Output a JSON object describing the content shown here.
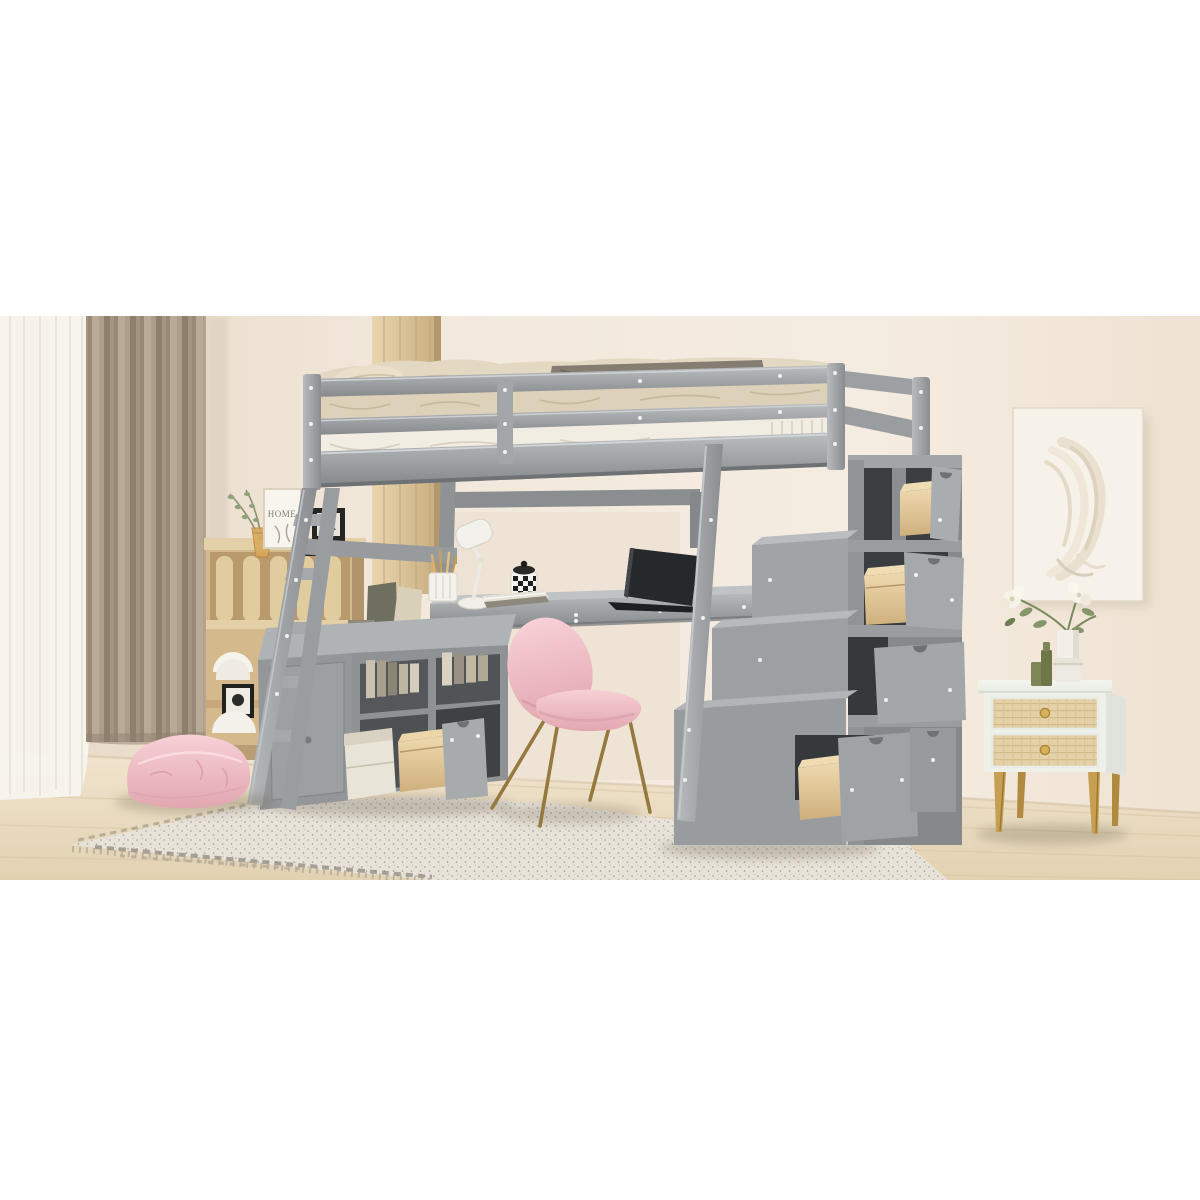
{
  "image": {
    "kind": "furniture-product-photo",
    "subject": "gray twin loft bed with under-bed desk, bookcase cabinet and storage staircase with pull-out drawers, staged in a bedroom",
    "letterbox": {
      "color": "#ffffff",
      "photo_top_px": 316,
      "photo_bottom_px": 880
    }
  },
  "decor": {
    "frame_text": "HOME"
  },
  "palette": {
    "wall": "#f1e7da",
    "wall_shadow": "#e5d7c4",
    "curtain_taupe": "#a69783",
    "sheer_curtain": "#f7f4ed",
    "wood_floor": "#e9dbc0",
    "rug": "#e8e3da",
    "rug_band": "#847d71",
    "furniture_gray": "#9b9ea1",
    "furniture_gray_dark": "#7d8083",
    "furniture_gray_light": "#b7babc",
    "drawer_interior": "#3f4245",
    "drawer_wood": "#ddc190",
    "bedding_beige": "#ddd1ba",
    "throw_taupe": "#857d72",
    "mattress_white": "#f2ede2",
    "oak_wood": "#d6ba8e",
    "chair_pink": "#f0bcc3",
    "pouf_pink": "#f0c3c8",
    "gold_metal": "#b99350",
    "nightstand_white": "#eef1ea",
    "rattan": "#e3d0a8",
    "laptop_dark": "#26292c",
    "leaf_green": "#85966b",
    "candle_olive": "#747b4e",
    "art_canvas": "#f6f2ea"
  },
  "objects": [
    "sheer-curtain",
    "taupe-curtain",
    "wood-column",
    "wall-art",
    "bookshelf",
    "home-frame",
    "eucalyptus-vase",
    "loft-bed",
    "guardrail",
    "pillows",
    "bedding",
    "throw-blanket",
    "ladder",
    "under-bed-desk",
    "desk-lamp",
    "pencil-cup",
    "checkered-cup",
    "book-stack",
    "laptop",
    "storage-cabinet",
    "open-cabinet-drawer",
    "storage-box",
    "desk-chair",
    "storage-staircase",
    "staircase-open-drawers",
    "nightstand",
    "flower-vase",
    "green-candles",
    "floor-cushion",
    "area-rug"
  ]
}
